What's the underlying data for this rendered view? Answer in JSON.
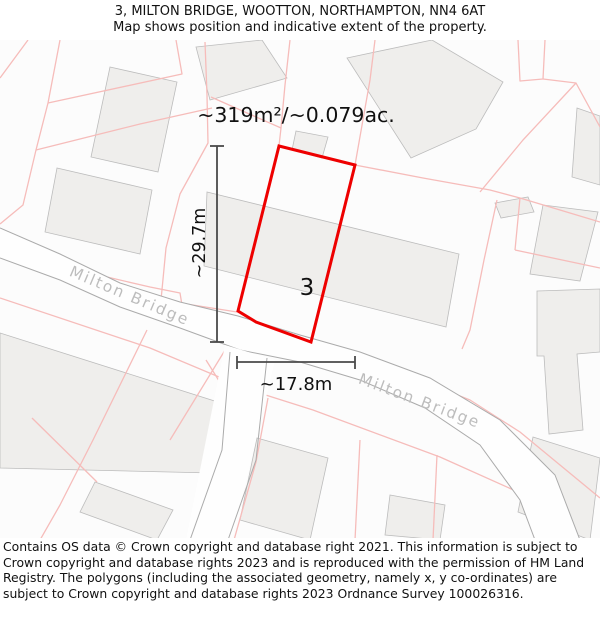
{
  "header": {
    "title": "3, MILTON BRIDGE, WOOTTON, NORTHAMPTON, NN4 6AT",
    "subtitle": "Map shows position and indicative extent of the property."
  },
  "map": {
    "area_label": "~319m²/~0.079ac.",
    "height_label": "~29.7m",
    "width_label": "~17.8m",
    "plot_number": "3",
    "road_name": "Milton Bridge",
    "colors": {
      "plot_outline": "#ee0000",
      "parcel_line": "#f6bcba",
      "building_fill": "#efeeec",
      "road_edge": "#ababab",
      "road_label": "#bdbdbd",
      "measure_line": "#4a4a4a",
      "map_background": "#fcfcfc"
    }
  },
  "footer": {
    "text": "Contains OS data © Crown copyright and database right 2021. This information is subject to Crown copyright and database rights 2023 and is reproduced with the permission of HM Land Registry. The polygons (including the associated geometry, namely x, y co-ordinates) are subject to Crown copyright and database rights 2023 Ordnance Survey 100026316."
  }
}
